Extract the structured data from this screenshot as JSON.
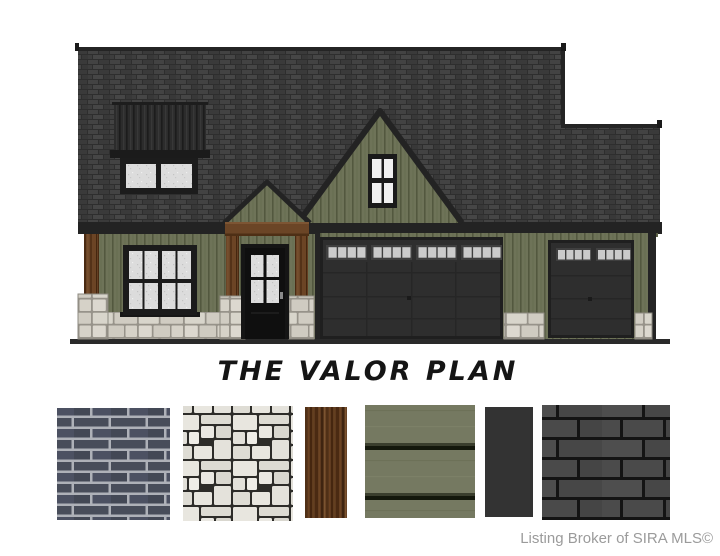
{
  "title": "THE VALOR PLAN",
  "credit": "Listing Broker of SIRA MLS©",
  "colors": {
    "background": "#ffffff",
    "title-color": "#151515",
    "credit-color": "#9b9b9b",
    "roof": "#2e2e2e",
    "trim": "#232323",
    "siding": "#6e7358",
    "siding-batten": "#53583f",
    "stone": "#d8d5cb",
    "stone-joint": "#97938a",
    "wood": "#6b4526",
    "glass": "#dcdcdc",
    "glass-bright": "#f0f0f0",
    "door": "#0f0f0f",
    "garage-door": "#2e2e2e",
    "garage-door-frame": "#1f1f1f",
    "garage-window": "#cbcbcb",
    "swatch-brick": "#484d5a",
    "swatch-brick-mortar": "#aeb1b8",
    "swatch-stone": "#e8e6df",
    "swatch-stone-joint": "#2d2c29",
    "swatch-wood": "#5e3a1f",
    "swatch-siding": "#757961",
    "swatch-trim": "#333333",
    "swatch-shingle": "#4a4a4a"
  },
  "swatches": [
    {
      "id": "brick"
    },
    {
      "id": "stone"
    },
    {
      "id": "wood"
    },
    {
      "id": "lap-siding"
    },
    {
      "id": "trim"
    },
    {
      "id": "shingles"
    }
  ]
}
